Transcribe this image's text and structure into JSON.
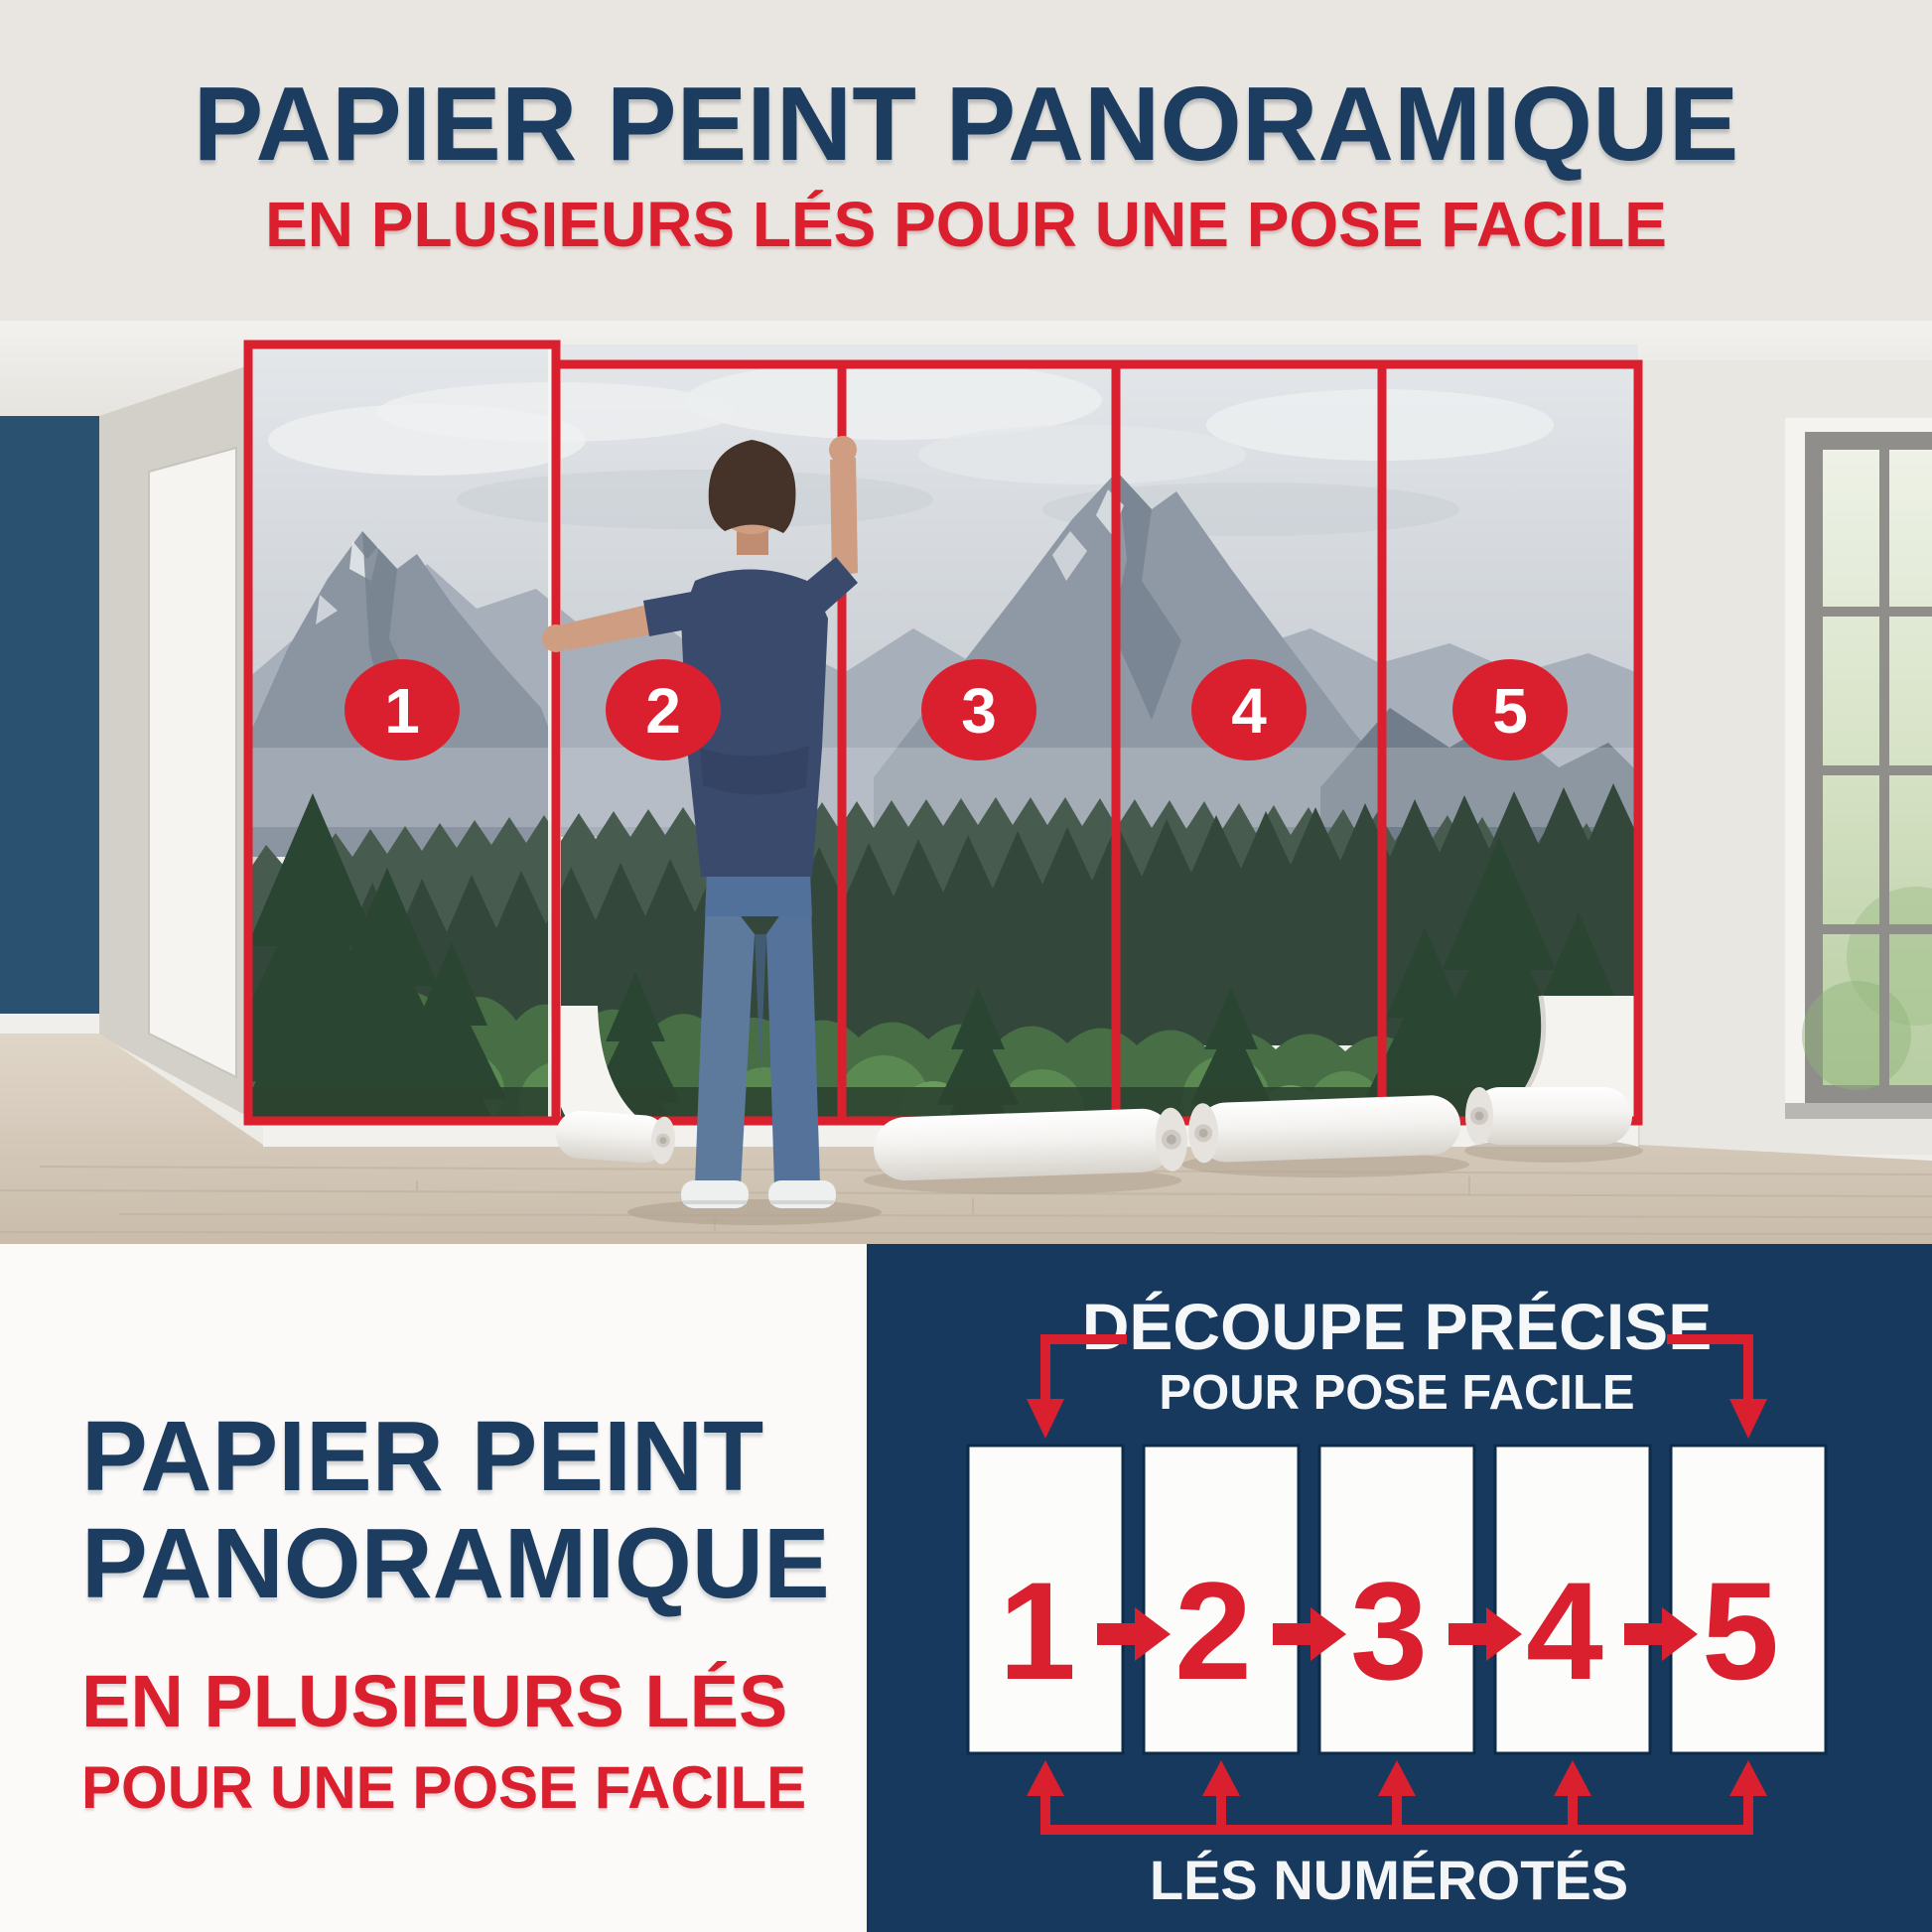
{
  "header": {
    "title": "PAPIER PEINT PANORAMIQUE",
    "subtitle": "EN PLUSIEURS LÉS POUR UNE POSE FACILE"
  },
  "photo": {
    "description": "room with man hanging panoramic mountain-forest wallpaper in five numbered strips",
    "strips": [
      "1",
      "2",
      "3",
      "4",
      "5"
    ]
  },
  "bottom_left": {
    "title_line1": "PAPIER PEINT",
    "title_line2": "PANORAMIQUE",
    "subtitle_line1": "EN PLUSIEURS LÉS",
    "subtitle_line2": "POUR UNE POSE FACILE"
  },
  "diagram": {
    "title_line1": "DÉCOUPE PRÉCISE",
    "title_line2": "POUR POSE FACILE",
    "strip_numbers": [
      "1",
      "2",
      "3",
      "4",
      "5"
    ],
    "caption": "LÉS NUMÉROTÉS",
    "arrow_between_icon": "arrow-right",
    "arrow_under_icon": "arrow-up",
    "corner_connector_icon": "arrow-elbow-down"
  },
  "colors": {
    "navy": "#1c3c60",
    "red": "#da202e",
    "diagram-bg": "#16395d",
    "band": "#e9e6e1",
    "paper": "#fbfaf8",
    "accent-wall": "#2a5170"
  }
}
